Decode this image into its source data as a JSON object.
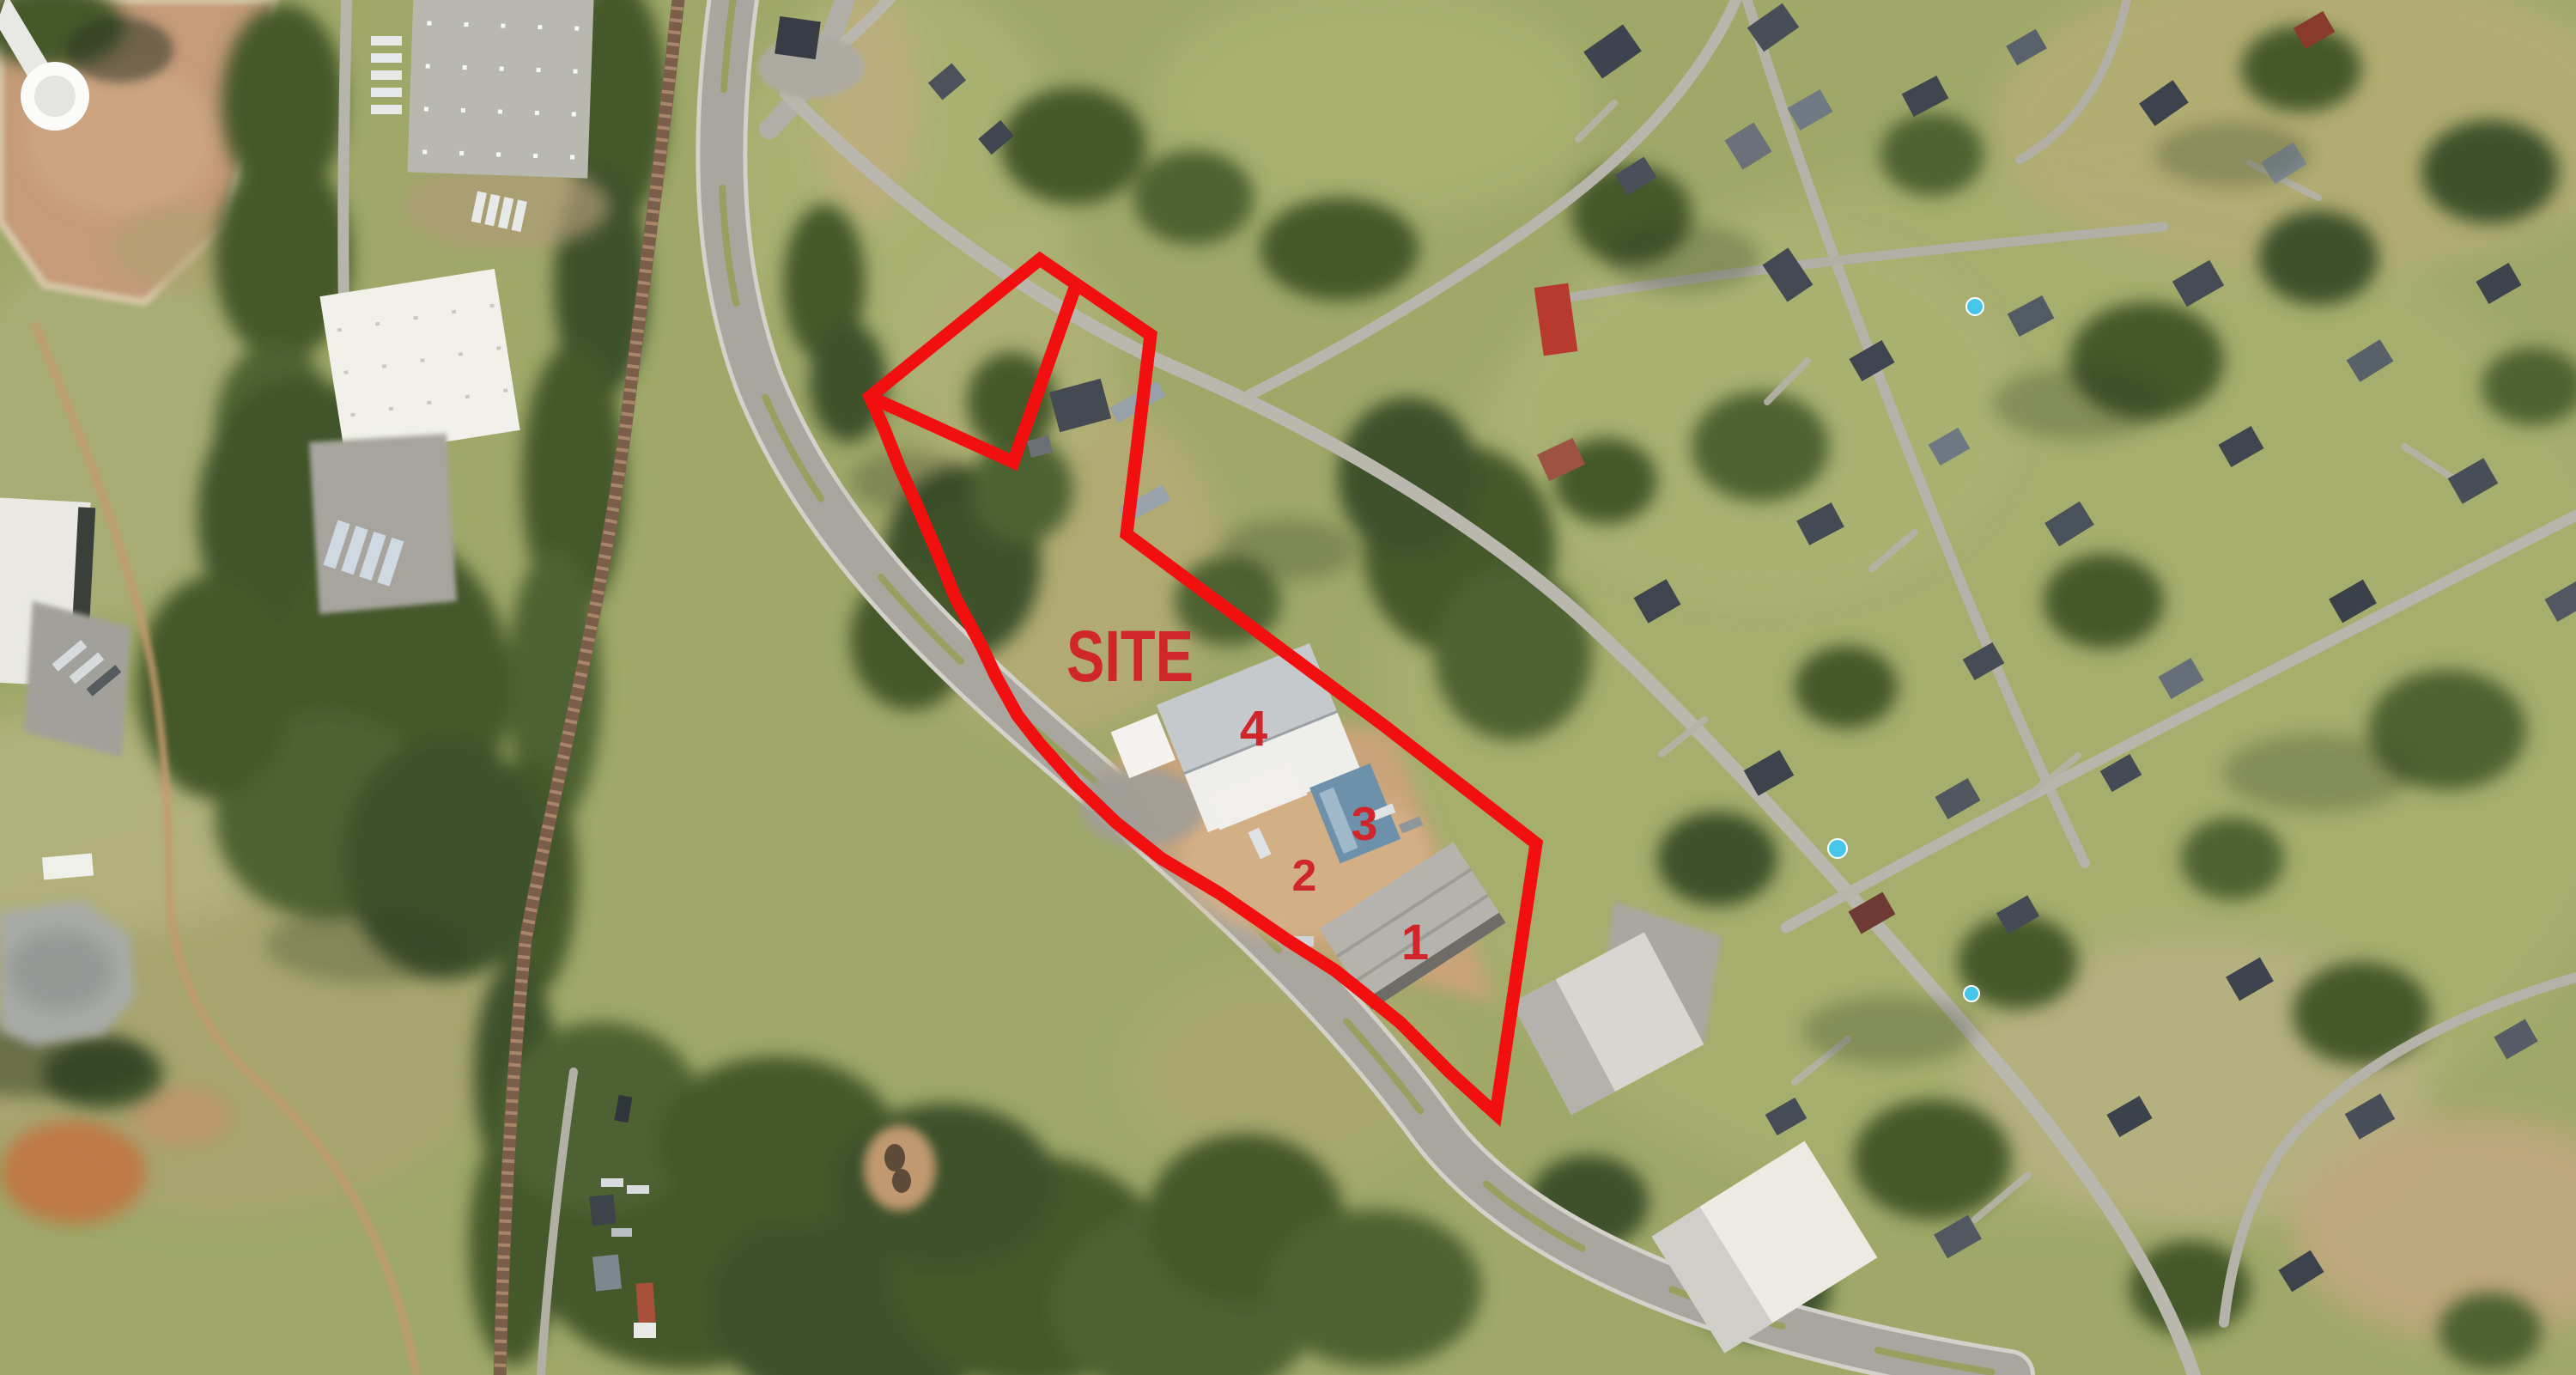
{
  "page": {
    "type": "aerial-satellite-site-map",
    "description": "Satellite aerial photograph with a red hand-drawn property boundary outline, a SITE label and four numbered building markers"
  },
  "annotations": {
    "site_label": "SITE",
    "markers": [
      {
        "label": "1"
      },
      {
        "label": "2"
      },
      {
        "label": "3"
      },
      {
        "label": "4"
      }
    ],
    "outline_color": "#f20f0f",
    "label_color": "#d0262a"
  },
  "scene": {
    "features": [
      "divided highway curving from top-left to bottom-right",
      "railroad corridor on the left",
      "industrial warehouses in the top-left",
      "water tower in the top-left corner",
      "residential neighborhood with streets and houses on the right half",
      "outlined site parcel with four industrial buildings",
      "gray pond in the lower-left",
      "woodland bands along the railroad and bottom of the image"
    ],
    "palette": {
      "grass": "#9fa869",
      "dry_field": "#b3ad74",
      "forest": "#44582c",
      "dirt": "#c9a379",
      "pink_dirt": "#c59b7a",
      "road": "#bab7ae",
      "highway": "#a8a69e",
      "railroad": "#7a5e4a",
      "warehouse_white": "#f1f0ea",
      "warehouse_gray": "#b8b8b1",
      "roof_dark": "#3d444e",
      "roof_blue": "#6d90ab",
      "roof_red": "#b8392e",
      "pool_blue": "#45c6ea",
      "pond_gray": "#a7aaa6"
    }
  }
}
